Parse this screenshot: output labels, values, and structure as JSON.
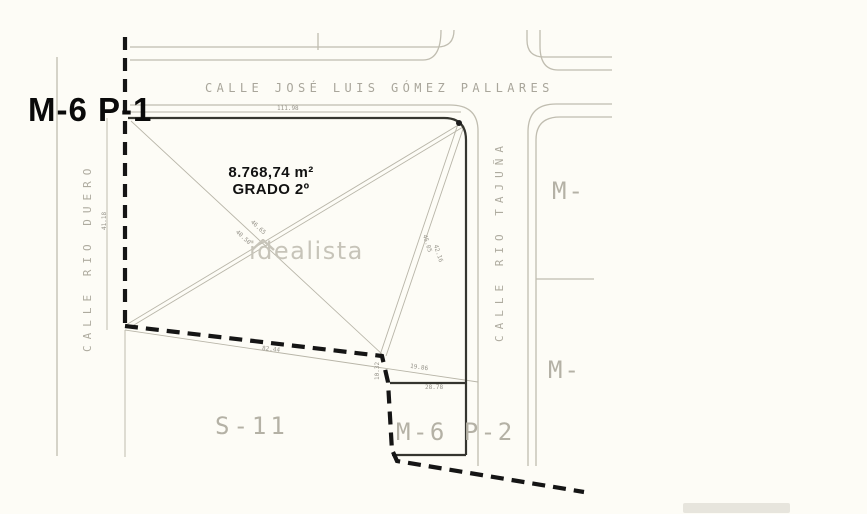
{
  "plan": {
    "main_parcel": {
      "label": "M-6 P-1",
      "area": "8.768,74 m²",
      "grade": "GRADO 2º"
    },
    "streets": {
      "top": "CALLE JOSÉ LUIS GÓMEZ PALLARES",
      "left": "CALLE RIO DUERO",
      "right": "CALLE RIO TAJUÑA"
    },
    "neighbor_parcels": {
      "bottom_left": "S-11",
      "bottom_right": "M-6 P-2",
      "right_upper": "M-",
      "right_lower": "M-"
    },
    "watermark": "idealista",
    "dimensions": {
      "top_edge": "111.98",
      "left_edge": "41.18",
      "bottom_edge": "82.44",
      "diag_a": "40.50",
      "diag_b": "46.65",
      "diag_c": "45.05",
      "diag_d": "42.16",
      "sub_top": "28.78",
      "sub_diag": "19.86",
      "sub_left": "10.32"
    }
  },
  "colors": {
    "background": "#fdfcf6",
    "street_line": "#c0bdb0",
    "survey_line": "#b8b5a8",
    "parcel_dark": "#35352f",
    "boundary_dashed": "#151515",
    "grey_label": "#b4b1a5",
    "watermark_grey": "#c7c4b9"
  }
}
